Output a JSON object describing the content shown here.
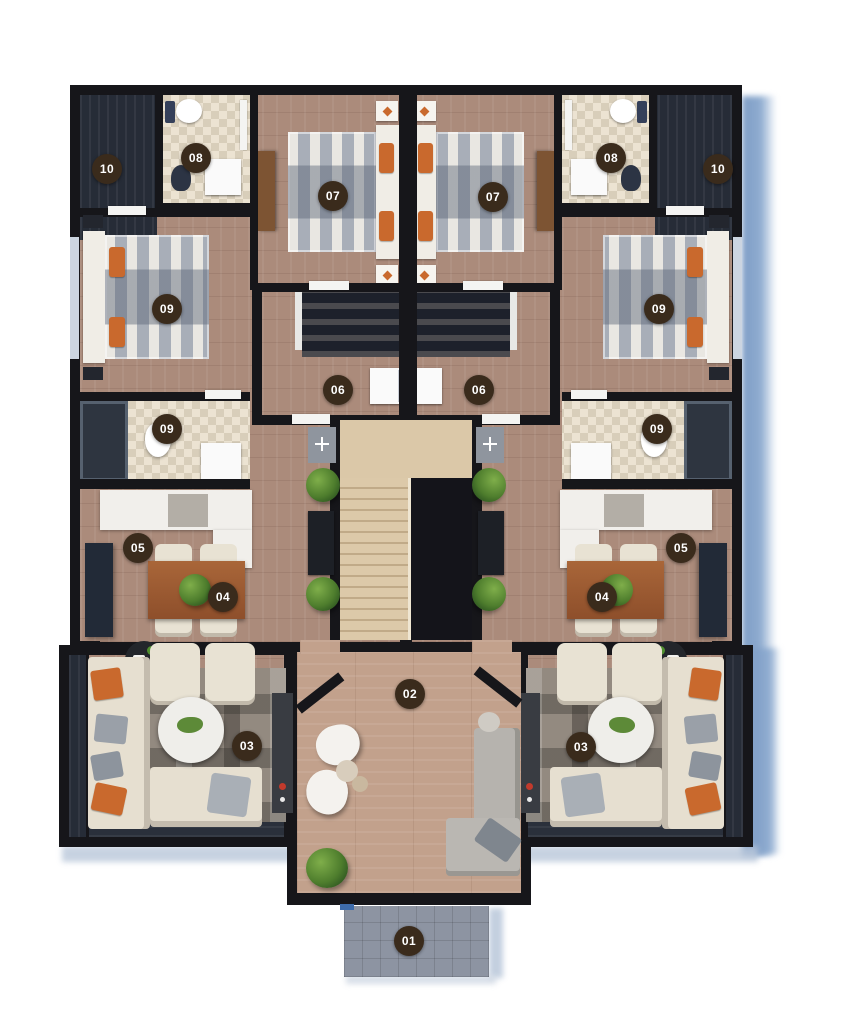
{
  "figure": {
    "type": "apartment-floor-plan-3d-render",
    "background": "#ffffff",
    "units": "two mirrored units around central stair"
  },
  "palette": {
    "badge_bg": "#3a2b1c",
    "badge_text": "#ffffff",
    "wall": "#16161a",
    "wood_floor": "#ab8b7b",
    "corridor_floor": "#c2a18c",
    "tile_floor": "#e7decd",
    "stairs": "#dbc8a8",
    "shadow": "#7f9ec7",
    "entrance_pad": "#8d94a2",
    "accent_orange": "#c9692d",
    "table_wood": "#9e5e36",
    "plant_green": "#4e7d2d"
  },
  "badges": [
    {
      "id": "entrance-01",
      "label": "01",
      "x": 409,
      "y": 941
    },
    {
      "id": "corridor-02",
      "label": "02",
      "x": 410,
      "y": 694
    },
    {
      "id": "living-03-left",
      "label": "03",
      "x": 247,
      "y": 746
    },
    {
      "id": "living-03-right",
      "label": "03",
      "x": 581,
      "y": 747
    },
    {
      "id": "dining-04-left",
      "label": "04",
      "x": 223,
      "y": 597
    },
    {
      "id": "dining-04-right",
      "label": "04",
      "x": 602,
      "y": 597
    },
    {
      "id": "kitchen-05-left",
      "label": "05",
      "x": 138,
      "y": 548
    },
    {
      "id": "kitchen-05-right",
      "label": "05",
      "x": 681,
      "y": 548
    },
    {
      "id": "laundry-06-left",
      "label": "06",
      "x": 338,
      "y": 390
    },
    {
      "id": "laundry-06-right",
      "label": "06",
      "x": 479,
      "y": 390
    },
    {
      "id": "bedroom-07-left",
      "label": "07",
      "x": 333,
      "y": 196
    },
    {
      "id": "bedroom-07-right",
      "label": "07",
      "x": 493,
      "y": 197
    },
    {
      "id": "bathroom-08-left",
      "label": "08",
      "x": 196,
      "y": 158
    },
    {
      "id": "bathroom-08-right",
      "label": "08",
      "x": 611,
      "y": 158
    },
    {
      "id": "bedroom-09-left",
      "label": "09",
      "x": 167,
      "y": 309
    },
    {
      "id": "bedroom-09-right",
      "label": "09",
      "x": 659,
      "y": 309
    },
    {
      "id": "bathroom-09-left",
      "label": "09",
      "x": 167,
      "y": 429
    },
    {
      "id": "bathroom-09-right",
      "label": "09",
      "x": 657,
      "y": 429
    },
    {
      "id": "balcony-10-left",
      "label": "10",
      "x": 107,
      "y": 169
    },
    {
      "id": "balcony-10-right",
      "label": "10",
      "x": 718,
      "y": 169
    }
  ]
}
